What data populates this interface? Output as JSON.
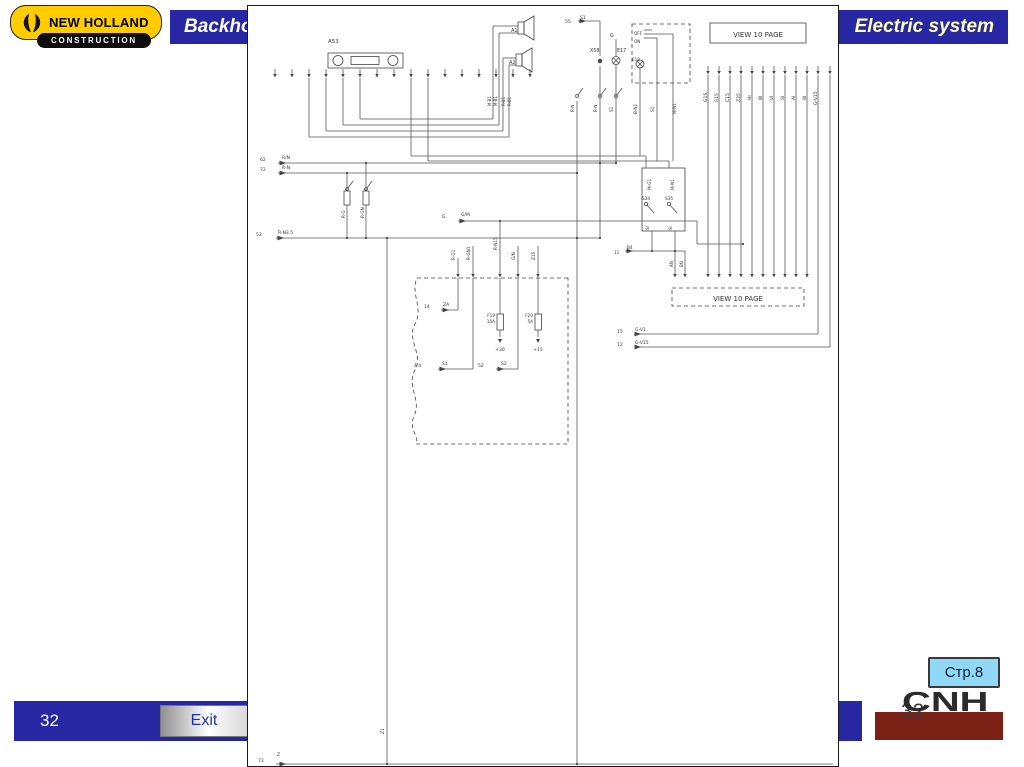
{
  "header": {
    "logo": {
      "brand": "NEW HOLLAND",
      "division": "CONSTRUCTION"
    },
    "bar_left_title": "Backho",
    "bar_right_title": "Electric system"
  },
  "footer": {
    "slide_number": "32",
    "exit_label": "Exit",
    "page_ref": "Стр.8",
    "cnh_text": "CNH",
    "cnh_watermark": "32"
  },
  "colors": {
    "bar_blue": "#2727A3",
    "logo_yellow": "#FFCC00",
    "logo_black": "#0d0d0d",
    "title_yellow": "#FFFFB8",
    "cnh_red": "#7B2015",
    "badge_blue": "#8FD8F6",
    "exit_text_blue": "#2233aa",
    "schematic_line": "#555"
  },
  "diagram": {
    "solid_boxes": [
      [
        462,
        17,
        96,
        20
      ],
      [
        394,
        162,
        43,
        63
      ]
    ],
    "dashed_boxes": [
      [
        384,
        18,
        58,
        59
      ],
      [
        424,
        282,
        132,
        18
      ]
    ],
    "wavy_box": "M320,272 L169,272 C162,288 176,302 167,318 C158,334 176,348 167,364 C158,380 174,394 166,410 C160,424 172,430 168,438 L320,438 Z",
    "lines": [
      [
        61,
        72,
        61,
        131
      ],
      [
        78,
        72,
        78,
        125
      ],
      [
        95,
        72,
        95,
        119
      ],
      [
        112,
        72,
        112,
        113
      ],
      [
        112,
        113,
        245,
        113
      ],
      [
        95,
        119,
        251,
        119
      ],
      [
        78,
        125,
        255,
        125
      ],
      [
        61,
        131,
        261,
        131
      ],
      [
        245,
        20,
        245,
        113
      ],
      [
        245,
        20,
        270,
        20
      ],
      [
        251,
        27,
        251,
        119
      ],
      [
        251,
        27,
        270,
        27
      ],
      [
        255,
        52,
        255,
        125
      ],
      [
        255,
        52,
        268,
        52
      ],
      [
        261,
        59,
        261,
        131
      ],
      [
        261,
        59,
        268,
        59
      ],
      [
        330,
        15,
        352,
        15
      ],
      [
        352,
        15,
        352,
        50
      ],
      [
        352,
        60,
        352,
        232
      ],
      [
        368,
        33,
        368,
        50
      ],
      [
        368,
        59,
        368,
        157
      ],
      [
        396,
        24,
        404,
        24
      ],
      [
        396,
        28,
        404,
        28
      ],
      [
        396,
        32,
        404,
        32
      ],
      [
        404,
        28,
        425,
        28
      ],
      [
        404,
        32,
        409,
        32
      ],
      [
        392,
        62,
        392,
        150
      ],
      [
        409,
        32,
        409,
        155
      ],
      [
        425,
        28,
        425,
        155
      ],
      [
        163,
        72,
        163,
        150
      ],
      [
        163,
        150,
        398,
        150
      ],
      [
        398,
        150,
        398,
        162
      ],
      [
        180,
        72,
        180,
        155
      ],
      [
        180,
        155,
        421,
        155
      ],
      [
        421,
        155,
        421,
        162
      ],
      [
        30,
        157,
        368,
        157
      ],
      [
        30,
        167,
        329,
        167
      ],
      [
        28,
        232,
        352,
        232
      ],
      [
        99,
        167,
        99,
        185
      ],
      [
        99,
        199,
        99,
        232
      ],
      [
        118,
        157,
        118,
        185
      ],
      [
        118,
        199,
        118,
        232
      ],
      [
        210,
        215,
        449,
        215
      ],
      [
        449,
        215,
        449,
        238
      ],
      [
        449,
        238,
        495,
        238
      ],
      [
        404,
        225,
        404,
        245
      ],
      [
        427,
        225,
        427,
        263
      ],
      [
        377,
        245,
        437,
        245
      ],
      [
        437,
        245,
        437,
        263
      ],
      [
        210,
        252,
        210,
        263
      ],
      [
        225,
        240,
        225,
        263
      ],
      [
        252,
        215,
        252,
        263
      ],
      [
        270,
        240,
        270,
        263
      ],
      [
        290,
        240,
        290,
        263
      ],
      [
        210,
        272,
        210,
        304
      ],
      [
        193,
        304,
        210,
        304
      ],
      [
        225,
        272,
        225,
        363
      ],
      [
        190,
        363,
        225,
        363
      ],
      [
        252,
        272,
        252,
        308
      ],
      [
        252,
        324,
        252,
        331
      ],
      [
        270,
        272,
        270,
        363
      ],
      [
        248,
        363,
        270,
        363
      ],
      [
        290,
        272,
        290,
        308
      ],
      [
        290,
        324,
        290,
        331
      ],
      [
        460,
        69,
        460,
        263
      ],
      [
        471,
        69,
        471,
        263
      ],
      [
        482,
        69,
        482,
        263
      ],
      [
        493,
        69,
        493,
        263
      ],
      [
        504,
        69,
        504,
        263
      ],
      [
        515,
        69,
        515,
        263
      ],
      [
        526,
        69,
        526,
        263
      ],
      [
        537,
        69,
        537,
        263
      ],
      [
        548,
        69,
        548,
        263
      ],
      [
        559,
        69,
        559,
        263
      ],
      [
        570,
        69,
        570,
        328
      ],
      [
        582,
        69,
        582,
        341
      ],
      [
        387,
        328,
        570,
        328
      ],
      [
        390,
        341,
        582,
        341
      ],
      [
        139,
        232,
        139,
        758
      ],
      [
        329,
        95,
        329,
        758
      ],
      [
        28,
        758,
        585,
        758
      ]
    ],
    "pin_rows": [
      {
        "y": 63,
        "xs": [
          27,
          44,
          61,
          78,
          95,
          112,
          129,
          146,
          163,
          180,
          197,
          214,
          231,
          248,
          265,
          282
        ]
      },
      {
        "y": 60,
        "xs": [
          460,
          471,
          482,
          493,
          504,
          515,
          526,
          537,
          548,
          559,
          570,
          582
        ]
      },
      {
        "y": 263,
        "xs": [
          427,
          437,
          460,
          471,
          482,
          493,
          504,
          515,
          526,
          537,
          548,
          559
        ]
      },
      {
        "y": 263,
        "xs": [
          210,
          225,
          252,
          270,
          290
        ]
      }
    ],
    "labels": [
      [
        80,
        37,
        "A53",
        5.5
      ],
      [
        263,
        26,
        "A1",
        5
      ],
      [
        261,
        58,
        "A2",
        5
      ],
      [
        317,
        17,
        "55",
        4.5
      ],
      [
        332,
        13,
        "S1",
        4.5
      ],
      [
        342,
        46,
        "X58",
        4.8
      ],
      [
        362,
        31,
        "G",
        4.8
      ],
      [
        369,
        46,
        "E17",
        4.8
      ],
      [
        386,
        29,
        "OFF",
        4.2
      ],
      [
        386,
        37,
        "ON",
        4.2
      ],
      [
        384,
        55,
        "E18",
        4.2
      ],
      [
        510,
        31,
        "VIEW 10 PAGE",
        7,
        "m"
      ],
      [
        490,
        295,
        "VIEW 10 PAGE",
        7,
        "m"
      ],
      [
        12,
        155,
        "62",
        4.5
      ],
      [
        34,
        153,
        "R/N",
        4.5
      ],
      [
        12,
        165,
        "72",
        4.5
      ],
      [
        34,
        163,
        "R-N",
        4.5
      ],
      [
        8,
        230,
        "53",
        4.5
      ],
      [
        30,
        228,
        "R-N3.5",
        4.5
      ],
      [
        194,
        212,
        "G",
        4.5
      ],
      [
        213,
        210,
        "G/M",
        4.5
      ],
      [
        176,
        302,
        "14",
        4.5
      ],
      [
        195,
        300,
        "ZA",
        4.5
      ],
      [
        166,
        361,
        "4.4",
        4.5
      ],
      [
        194,
        359,
        "S1",
        4.5
      ],
      [
        230,
        361,
        "52",
        4.5
      ],
      [
        253,
        359,
        "S2",
        4.5
      ],
      [
        247,
        311,
        "F19",
        4.2,
        "e"
      ],
      [
        247,
        317,
        "10A",
        4.2,
        "e"
      ],
      [
        252,
        345,
        "+30",
        4.5,
        "m"
      ],
      [
        285,
        311,
        "F20",
        4.2,
        "e"
      ],
      [
        285,
        317,
        "5A",
        4.2,
        "e"
      ],
      [
        290,
        345,
        "+15",
        4.5,
        "m"
      ],
      [
        366,
        248,
        "11",
        4.2
      ],
      [
        379,
        243,
        "B4",
        4.2
      ],
      [
        369,
        327,
        "15",
        4.5
      ],
      [
        387,
        325,
        "G-V1",
        4.5
      ],
      [
        369,
        340,
        "12",
        4.5
      ],
      [
        387,
        338,
        "G-V15",
        4.5
      ],
      [
        10,
        756,
        "73",
        4.5
      ],
      [
        29,
        750,
        "Z",
        4.5
      ],
      [
        394,
        194,
        "S34",
        4.2
      ],
      [
        417,
        194,
        "S35",
        4.2
      ]
    ],
    "vlabels": [
      [
        97,
        212,
        "R-G",
        4.2
      ],
      [
        116,
        212,
        "R-GN",
        4.2
      ],
      [
        207,
        254,
        "R-G1",
        4.2
      ],
      [
        222,
        254,
        "R-GN1",
        4.2
      ],
      [
        249,
        244,
        "R-N15",
        4.2
      ],
      [
        267,
        254,
        "G/N",
        4.2
      ],
      [
        287,
        254,
        "Z15",
        4.2
      ],
      [
        326,
        106,
        "R-N",
        4.2
      ],
      [
        349,
        106,
        "R-N",
        4.2
      ],
      [
        365,
        106,
        "S1",
        4.2
      ],
      [
        389,
        108,
        "B-N1",
        4.2
      ],
      [
        406,
        106,
        "S1",
        4.2
      ],
      [
        428,
        108,
        "M-N1",
        4.2
      ],
      [
        403,
        184,
        "M-G1",
        4.2
      ],
      [
        426,
        184,
        "M-N1",
        4.2
      ],
      [
        401,
        224,
        "SI",
        4
      ],
      [
        424,
        224,
        "SI",
        4
      ],
      [
        425,
        261,
        "AN",
        4
      ],
      [
        435,
        261,
        "BN",
        4
      ],
      [
        136,
        728,
        "Z1",
        4.2
      ],
      [
        243,
        100,
        "M-B1",
        4
      ],
      [
        249,
        100,
        "M-B1",
        4
      ],
      [
        257,
        100,
        "R-B1",
        4
      ],
      [
        263,
        100,
        "R-B1",
        4
      ],
      [
        459,
        96,
        "G15",
        4.5
      ],
      [
        470,
        96,
        "R15",
        4.5
      ],
      [
        481,
        96,
        "C15",
        4.5
      ],
      [
        492,
        96,
        "Z25",
        4.5
      ],
      [
        503,
        94,
        "HI",
        4.5
      ],
      [
        514,
        94,
        "BI",
        4.5
      ],
      [
        525,
        94,
        "VI",
        4.5
      ],
      [
        536,
        94,
        "SI",
        4.5
      ],
      [
        547,
        94,
        "AI",
        4.5
      ],
      [
        558,
        94,
        "BI",
        4.5
      ],
      [
        569,
        99,
        "G-V15",
        4.5
      ]
    ],
    "dots": [
      [
        352,
        157
      ],
      [
        368,
        157
      ],
      [
        118,
        157
      ],
      [
        99,
        167
      ],
      [
        329,
        167
      ],
      [
        99,
        232
      ],
      [
        118,
        232
      ],
      [
        139,
        232
      ],
      [
        329,
        232
      ],
      [
        352,
        232
      ],
      [
        252,
        215
      ],
      [
        495,
        238
      ],
      [
        404,
        245
      ],
      [
        427,
        245
      ],
      [
        139,
        758
      ],
      [
        329,
        758
      ]
    ],
    "arrows": [
      [
        38,
        157
      ],
      [
        38,
        167
      ],
      [
        36,
        232
      ],
      [
        218,
        215
      ],
      [
        201,
        304
      ],
      [
        198,
        363
      ],
      [
        256,
        363
      ],
      [
        385,
        245
      ],
      [
        393,
        328
      ],
      [
        393,
        341
      ],
      [
        38,
        758
      ],
      [
        338,
        15
      ]
    ],
    "down_arrows": [
      [
        252,
        333
      ],
      [
        290,
        333
      ]
    ],
    "components": {
      "radio": {
        "x": 80,
        "y": 47,
        "w": 75,
        "h": 15,
        "knobs": [
          [
            90,
            54.5
          ],
          [
            145,
            54.5
          ]
        ],
        "slot": [
          103,
          50.5,
          28,
          8
        ]
      },
      "speakers": [
        {
          "rect": [
            270,
            16,
            6,
            12
          ],
          "horn": "276,16 286,10 286,34 276,28"
        },
        {
          "rect": [
            268,
            48,
            6,
            12
          ],
          "horn": "274,48 284,42 284,66 274,60"
        }
      ],
      "lamps": [
        [
          368,
          54.5
        ],
        [
          392,
          58
        ]
      ],
      "fuses": [
        [
          96,
          185,
          6,
          14
        ],
        [
          115,
          185,
          6,
          14
        ],
        [
          249,
          308,
          6.5,
          16
        ],
        [
          287,
          308,
          6.5,
          16
        ]
      ],
      "xconn": [
        [
          352,
          55
        ]
      ],
      "switches": [
        [
          398,
          198
        ],
        [
          421,
          198
        ]
      ],
      "contacts": [
        [
          329,
          90
        ],
        [
          352,
          90
        ],
        [
          368,
          90
        ],
        [
          99,
          183
        ],
        [
          118,
          183
        ]
      ]
    }
  }
}
